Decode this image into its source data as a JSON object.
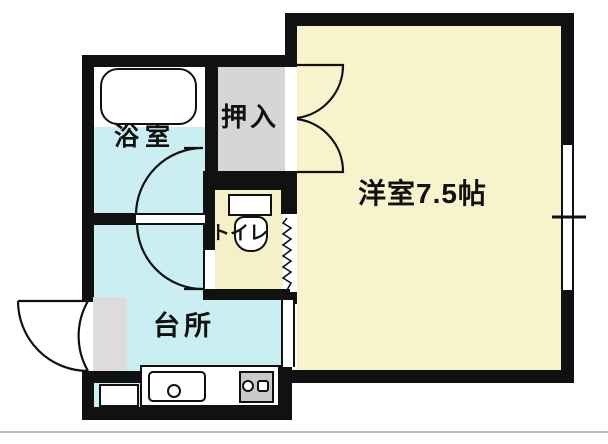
{
  "title": "apartment-floorplan",
  "rooms": {
    "bathroom": {
      "label": "浴室"
    },
    "closet": {
      "label": "押入"
    },
    "western_room": {
      "label": "洋室7.5帖",
      "size_tatami": "7.5帖"
    },
    "toilet": {
      "label": "トイレ"
    },
    "kitchen": {
      "label": "台所"
    }
  },
  "fixtures": [
    "bathtub",
    "toilet",
    "kitchen-sink",
    "stove-2-burner",
    "entry-step",
    "washer-pan",
    "closet-double-doors",
    "entry-door",
    "window"
  ],
  "colors": {
    "wall": "#111111",
    "wet_floor": "#cbeef2",
    "room_floor": "#f7f4cd",
    "toilet_floor": "#f4f1c9",
    "closet_fill": "#d6d6d6",
    "entry_fill": "#dcdcdc",
    "stove_fill": "#c9c9c9",
    "baseline": "#bcbcbc"
  }
}
